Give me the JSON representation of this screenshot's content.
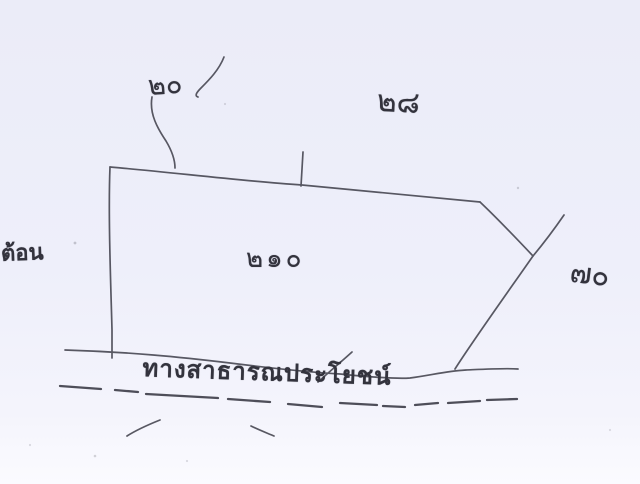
{
  "sketch": {
    "labels": {
      "top_left_measure": "๒๐",
      "top_right_measure": "๒๘",
      "parcel_number": "๒๑๐",
      "right_measure": "๗๐",
      "left_edge_text": "ต้อน",
      "road_name": "ทางสาธารณประโยชน์"
    },
    "colors": {
      "paper": "#eeeffa",
      "ink": "#42424d"
    }
  }
}
